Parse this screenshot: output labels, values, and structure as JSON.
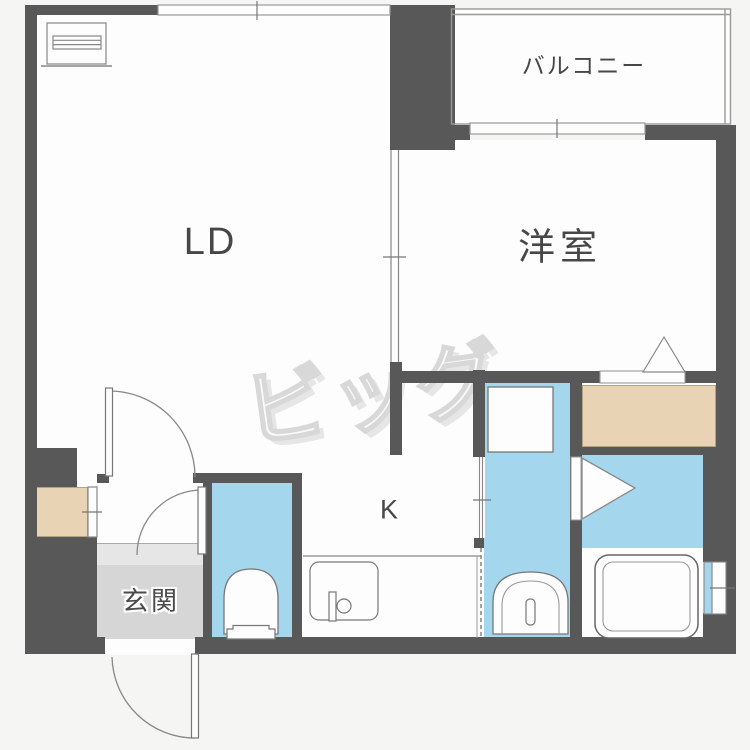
{
  "image_type": "apartment-floor-plan",
  "rooms": {
    "living_dining": {
      "label": "LD"
    },
    "western_room": {
      "label": "洋室"
    },
    "balcony": {
      "label": "バルコニー"
    },
    "kitchen": {
      "label": "K"
    },
    "entrance": {
      "label": "玄関"
    }
  },
  "watermark": {
    "text": "ビッグ"
  },
  "icons": [
    "heater-icon",
    "kitchen-sink-icon",
    "faucet-icon",
    "toilet-icon",
    "washbasin-icon",
    "washing-machine-pan-icon",
    "bathtub-icon",
    "door-swing-icon",
    "door-triangle-icon",
    "window-icon",
    "sliding-partition-icon"
  ],
  "colors": {
    "wall": "#585858",
    "wet": "#a4d6ee",
    "storage": "#e8d4b4",
    "genkan": "#d6d6d6",
    "step": "#e6e6e6",
    "floor": "#fdfdfd",
    "background": "#f5f5f3",
    "line": "#888888",
    "text": "#474747",
    "watermark": "#d8d8d8"
  }
}
